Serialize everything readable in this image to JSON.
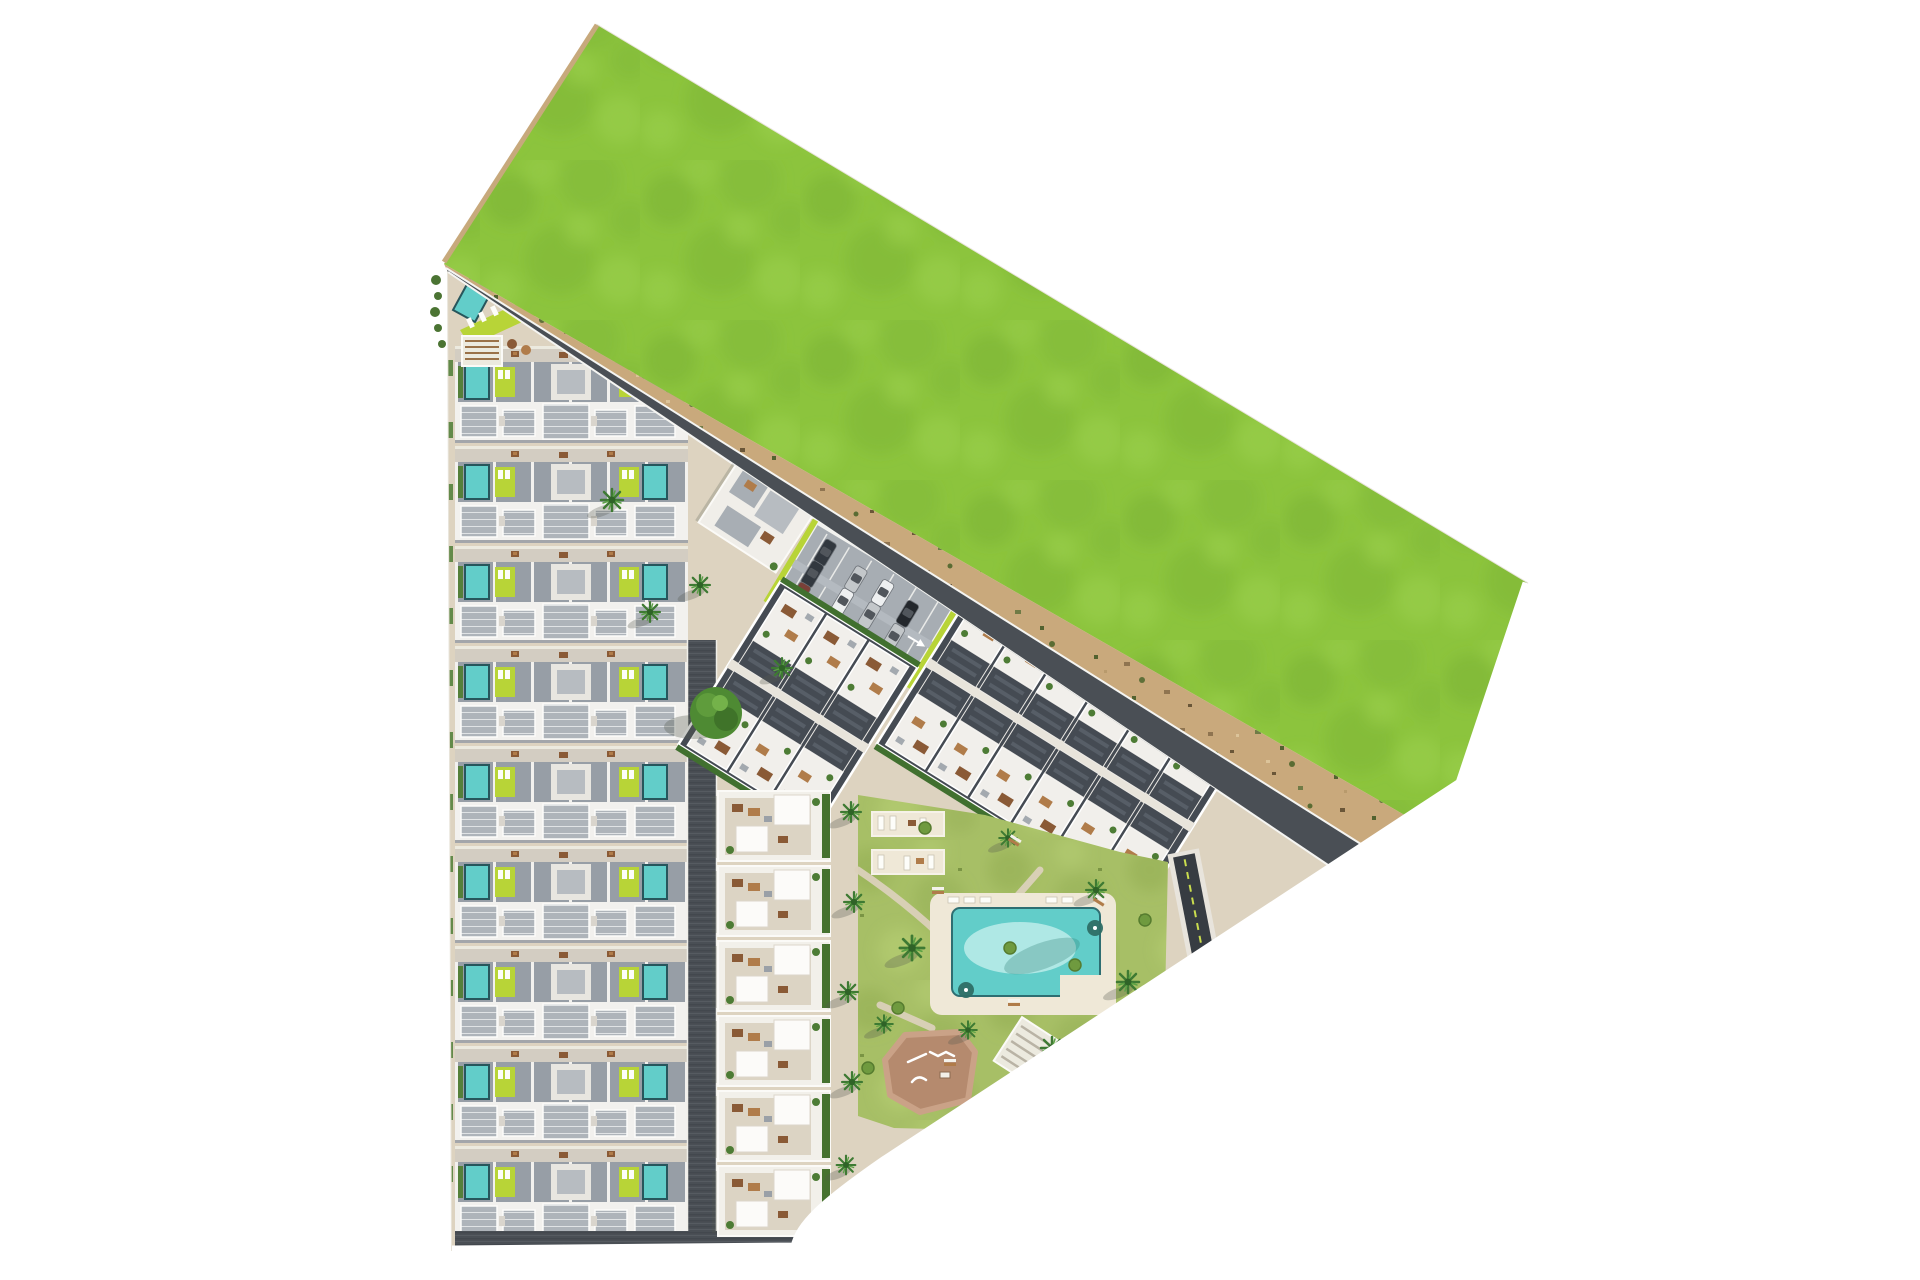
{
  "meta": {
    "title": "Aerial site plan rendering of a coastal residential development",
    "description": "Top-down 3D masterplan: nine rows of villas with private pools on the left, a central white apartment column, two angled apartment blocks along a diagonal sand road, communal gardens with swimming pool and playground, surface parking and a large undeveloped green field to the north-east."
  },
  "colors": {
    "rim": "#f6f3ed",
    "plaza": "#ddd3c0",
    "grassBase": "#8cc43d",
    "grassDark": "#7cb335",
    "grassLight": "#9ed24e",
    "sand": "#c9a97c",
    "road": "#4a4f55",
    "roadHatchA": "#43484e",
    "roadHatchB": "#565b61",
    "rowBase": "#d8d2c8",
    "terrace": "#979ea6",
    "roof": "#aeb4ba",
    "whiteWall": "#f2f1ee",
    "pool": "#62cdc9",
    "poolLight": "#bdecea",
    "lime": "#b8d437",
    "lawn": "#a7bf66",
    "lawnDark": "#93ad52",
    "lawnLight": "#b9d176",
    "hedge": "#4d7c35",
    "slate": "#454b53",
    "courtyard": "#dcd4c4",
    "brown": "#8a5a36",
    "brown2": "#b07c4a",
    "playground": "#b58a6e",
    "playgroundRim": "#caa287",
    "deck": "#efe8d7",
    "ramp": "#373c42",
    "rampLine": "#cadd4e",
    "shad": "#555a4f",
    "carWhite": "#eef0f1",
    "carSilver": "#c3c7ca",
    "carDark": "#32383f",
    "carBlack": "#23272c",
    "carRed": "#7a4038"
  },
  "layout": {
    "villa_rows": {
      "count": 9,
      "x": 455,
      "top": 346,
      "pitch": 100
    },
    "column_modules": {
      "count": 6,
      "x": 718,
      "top": 788,
      "pitch": 75
    },
    "ne_blocks": [
      {
        "cx": 798,
        "cy": 706,
        "rot": 32,
        "cols": 3
      },
      {
        "cx": 1060,
        "cy": 745,
        "rot": 32,
        "cols": 6
      }
    ],
    "parking": {
      "cx": 862,
      "cy": 604,
      "rot": 31,
      "w": 160,
      "h": 92,
      "cars": [
        [
          -58,
          -25,
          90,
          "carDark"
        ],
        [
          -58,
          0,
          90,
          "carDark"
        ],
        [
          -58,
          25,
          90,
          "carRed"
        ],
        [
          -18,
          -18,
          90,
          "carSilver"
        ],
        [
          -18,
          8,
          90,
          "carWhite"
        ],
        [
          12,
          -20,
          90,
          "carWhite"
        ],
        [
          12,
          6,
          90,
          "carSilver"
        ],
        [
          44,
          -15,
          90,
          "carBlack"
        ],
        [
          44,
          12,
          90,
          "carSilver"
        ]
      ]
    },
    "palms": [
      [
        716,
        713,
        2.0,
        "tree"
      ],
      [
        612,
        500,
        1.0,
        "palm"
      ],
      [
        650,
        612,
        0.9,
        "palm"
      ],
      [
        782,
        668,
        0.9,
        "palm"
      ],
      [
        700,
        585,
        0.9,
        "palm"
      ],
      [
        851,
        812,
        0.9,
        "palm"
      ],
      [
        854,
        902,
        0.9,
        "palm"
      ],
      [
        848,
        992,
        0.9,
        "palm"
      ],
      [
        852,
        1082,
        0.9,
        "palm"
      ],
      [
        846,
        1165,
        0.85,
        "palm"
      ],
      [
        912,
        948,
        1.1,
        "palm"
      ],
      [
        1052,
        1048,
        1.0,
        "palm"
      ],
      [
        1128,
        982,
        1.0,
        "palm"
      ],
      [
        968,
        1030,
        0.8,
        "palm"
      ],
      [
        1008,
        838,
        0.8,
        "palm"
      ],
      [
        1096,
        890,
        0.9,
        "palm"
      ],
      [
        884,
        1024,
        0.8,
        "palm"
      ],
      [
        898,
        1008,
        1,
        "bush"
      ],
      [
        952,
        1125,
        1,
        "bush"
      ],
      [
        1085,
        1108,
        1,
        "bush"
      ],
      [
        868,
        1068,
        1,
        "bush"
      ],
      [
        1010,
        948,
        1,
        "bush"
      ],
      [
        1075,
        965,
        1,
        "bush"
      ],
      [
        925,
        828,
        1,
        "bush"
      ],
      [
        1145,
        920,
        1,
        "bush"
      ]
    ],
    "benches": [
      [
        1015,
        840,
        32
      ],
      [
        1100,
        900,
        32
      ],
      [
        950,
        1062,
        0
      ],
      [
        1014,
        1002,
        0
      ],
      [
        938,
        890,
        0
      ]
    ],
    "road_arrows": [
      [
        1005,
        628,
        32
      ],
      [
        1152,
        728,
        32
      ]
    ],
    "left_hedges": {
      "count": 14,
      "x": 446,
      "top": 360,
      "pitch": 62
    }
  },
  "features": [
    "green-field",
    "sand-buffer",
    "perimeter-road",
    "villa-rows",
    "club-house",
    "surface-parking",
    "apartment-block-small",
    "apartment-block-large",
    "apartment-column",
    "communal-garden",
    "swimming-pool",
    "sun-deck",
    "playground",
    "basement-ramp",
    "palm-trees"
  ]
}
